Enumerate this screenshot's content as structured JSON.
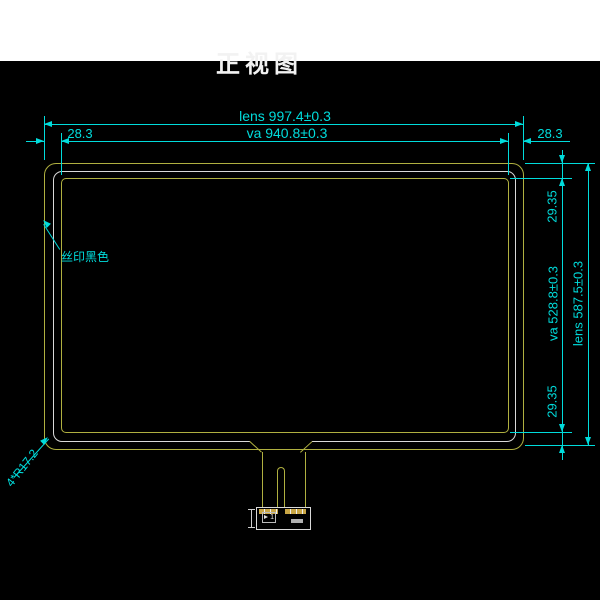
{
  "title": "正视图",
  "dims": {
    "lens_width": "lens 997.4±0.3",
    "va_width": "va 940.8±0.3",
    "margin_left": "28.3",
    "margin_right": "28.3",
    "margin_top": "29.35",
    "va_height": "va 528.8±0.3",
    "lens_height": "lens 587.5±0.3",
    "margin_bottom": "29.35",
    "corner_radius": "4*R17.2"
  },
  "labels": {
    "silk_print": "丝印黑色",
    "pin_marker": "1"
  },
  "colors": {
    "background": "#000000",
    "top_band": "#ffffff",
    "dimension_cyan": "#00dcdc",
    "outline_yellow": "#b0b040",
    "outline_white": "#d9d9d9"
  }
}
